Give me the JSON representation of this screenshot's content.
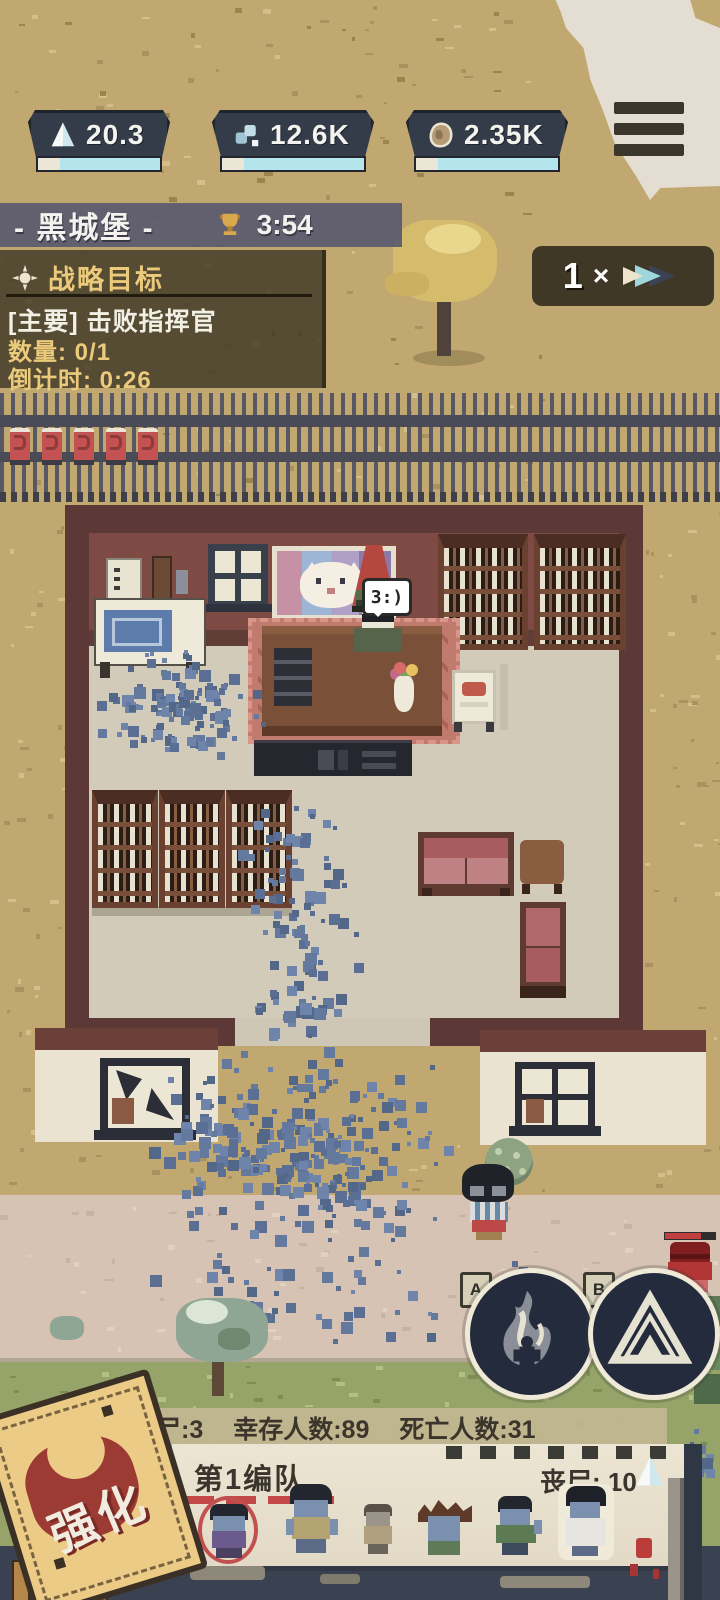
{
  "hud": {
    "resources": [
      {
        "icon": "sail-icon",
        "value": "20.3"
      },
      {
        "icon": "cubes-icon",
        "value": "12.6K"
      },
      {
        "icon": "stone-icon",
        "value": "2.35K"
      }
    ],
    "menu_icon": "hamburger-menu-icon"
  },
  "location_panel": {
    "title": "- 黑城堡 -",
    "timer": "3:54"
  },
  "objective_panel": {
    "title": "战略目标",
    "objective": "[主要] 击败指挥官",
    "quantity": "数量: 0/1",
    "countdown": "倒计时: 0:26"
  },
  "speed_control": {
    "value": "1",
    "times": "×"
  },
  "world": {
    "commander_speech": "3:)"
  },
  "ability_buttons": [
    {
      "key": "A",
      "icon": "bonfire-icon"
    },
    {
      "key": "B",
      "icon": "tent-icon"
    }
  ],
  "status_bar": {
    "zombies": "丧尸:3",
    "survivors": "幸存人数:89",
    "deaths": "死亡人数:31"
  },
  "squad_panel": {
    "title": "第1编队",
    "zombie_count": "丧尸: 10",
    "members": [
      {
        "icon": "zombie-purple-selected"
      },
      {
        "icon": "zombie-vest"
      },
      {
        "icon": "zombie-small-tan"
      },
      {
        "icon": "zombie-spiky-hair"
      },
      {
        "icon": "zombie-green-shirt"
      },
      {
        "icon": "zombie-doctor"
      }
    ]
  },
  "enhance_stamp": {
    "label": "强化"
  },
  "colors": {
    "hud_panel": "#343c49",
    "accent_cyan": "#b5e5ec",
    "gold": "#ecca7c",
    "debris": "#64799e",
    "selection_ring": "#c25050",
    "wall_maroon": "#7d4b44",
    "ground_tan": "#c1a871"
  }
}
